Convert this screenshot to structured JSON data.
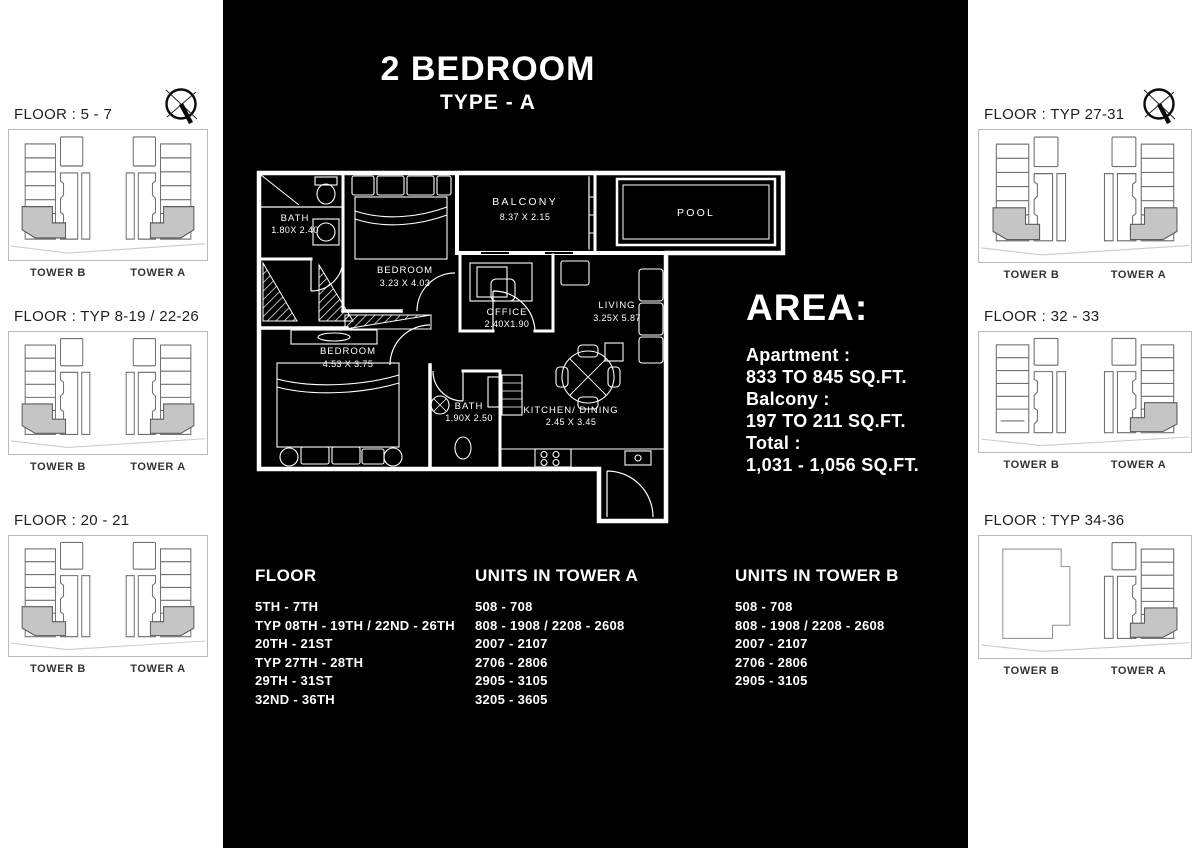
{
  "header": {
    "title": "2 BEDROOM",
    "subtitle": "TYPE - A"
  },
  "floorplan": {
    "rooms": {
      "bath1": {
        "name": "BATH",
        "dims": "1.80X 2.40"
      },
      "bedroom1": {
        "name": "BEDROOM",
        "dims": "3.23 X 4.03"
      },
      "balcony": {
        "name": "BALCONY",
        "dims": "8.37 X 2.15"
      },
      "pool": {
        "name": "POOL"
      },
      "office": {
        "name": "OFFICE",
        "dims": "2.40X1.90"
      },
      "living": {
        "name": "LIVING",
        "dims": "3.25X 5.87"
      },
      "bedroom2": {
        "name": "BEDROOM",
        "dims": "4.53 X 3.75"
      },
      "bath2": {
        "name": "BATH",
        "dims": "1.90X 2.50"
      },
      "kitchen": {
        "name": "KITCHEN/ DINING",
        "dims": "2.45 X 3.45"
      }
    }
  },
  "area": {
    "heading": "AREA:",
    "lines": [
      "Apartment :",
      "833 TO 845 SQ.FT.",
      "Balcony :",
      "197 TO 211 SQ.FT.",
      "Total :",
      "1,031 - 1,056 SQ.FT."
    ]
  },
  "floors": {
    "heading": "FLOOR",
    "items": [
      "5TH - 7TH",
      "TYP 08TH - 19TH / 22ND - 26TH",
      "20TH - 21ST",
      "TYP 27TH - 28TH",
      "29TH - 31ST",
      "32ND - 36TH"
    ]
  },
  "units_tower_a": {
    "heading": "UNITS IN TOWER A",
    "items": [
      "508 - 708",
      "808 - 1908 / 2208 - 2608",
      "2007 - 2107",
      "2706 - 2806",
      "2905 - 3105",
      "3205 - 3605"
    ]
  },
  "units_tower_b": {
    "heading": "UNITS IN TOWER B",
    "items": [
      "508 - 708",
      "808 - 1908 / 2208 - 2608",
      "2007 - 2107",
      "2706 - 2806",
      "2905 - 3105"
    ]
  },
  "keyplans": {
    "left": [
      {
        "title": "FLOOR : 5 - 7",
        "towers": [
          "TOWER B",
          "TOWER A"
        ],
        "variant": "both"
      },
      {
        "title": "FLOOR : TYP 8-19 / 22-26",
        "towers": [
          "TOWER B",
          "TOWER A"
        ],
        "variant": "both"
      },
      {
        "title": "FLOOR : 20 - 21",
        "towers": [
          "TOWER B",
          "TOWER A"
        ],
        "variant": "both"
      }
    ],
    "right": [
      {
        "title": "FLOOR : TYP 27-31",
        "towers": [
          "TOWER B",
          "TOWER A"
        ],
        "variant": "both"
      },
      {
        "title": "FLOOR : 32 - 33",
        "towers": [
          "TOWER B",
          "TOWER A"
        ],
        "variant": "a-only"
      },
      {
        "title": "FLOOR : TYP 34-36",
        "towers": [
          "TOWER B",
          "TOWER A"
        ],
        "variant": "a-only-b-outline"
      }
    ]
  },
  "colors": {
    "page_bg": "#ffffff",
    "panel_bg": "#000000",
    "text_on_dark": "#ffffff",
    "keyplan_line": "#6f6f6f",
    "keyplan_highlight": "#c5c5c5",
    "keyplan_ground": "#cccccc"
  }
}
